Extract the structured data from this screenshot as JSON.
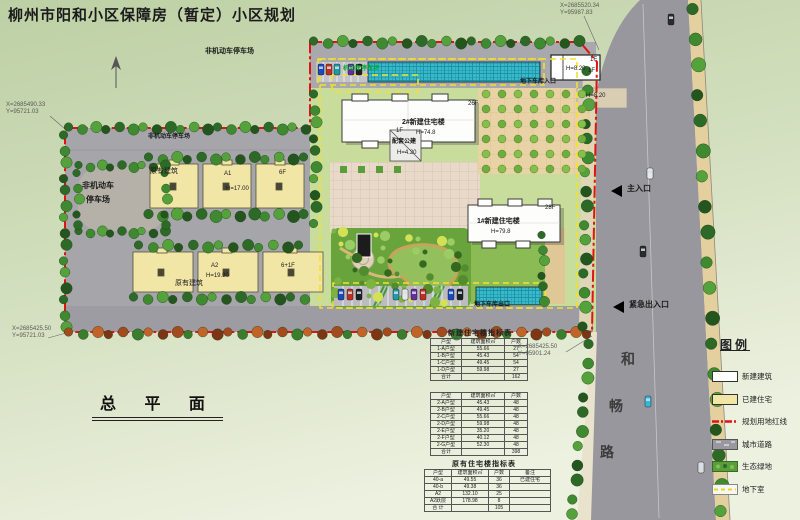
{
  "title": "柳州市阳和小区保障房（暂定）小区规划",
  "plan_name": "总 平 面",
  "coordinates": {
    "top_right": {
      "x": "X=2685520.34",
      "y": "Y=95987.83"
    },
    "mid_left": {
      "x": "X=2685490.33",
      "y": "Y=95721.03"
    },
    "bottom_left": {
      "x": "X=2685425.50",
      "y": "Y=95721.03"
    },
    "inner_right": {
      "x": "X=2685425.50",
      "y": "Y=95901.24"
    }
  },
  "labels": {
    "nonmotor_parking_top": "非机动车停车场",
    "motor_parking": "机动车停车场",
    "garage_entrance": "地下车库入口",
    "garage_exit": "地下车库出口",
    "nonmotor_parking_strip": "非机动车停车场",
    "nonmotor_lot_line1": "非机动车",
    "nonmotor_lot_line2": "停车场",
    "existing_building_1": "原有建筑",
    "existing_building_2": "原有建筑",
    "a1": "A1",
    "a1_height": "H=17.00",
    "a1_floors": "6F",
    "a2": "A2",
    "a2_height": "H=19.90",
    "a2_floors": "6+1F",
    "tower2_name": "2#新建住宅楼",
    "tower2_height": "H=74.8",
    "tower2_floors": "26F",
    "tower1_name": "1#新建住宅楼",
    "tower1_height": "H=79.8",
    "tower1_floors": "28F",
    "annex_floor": "1F",
    "annex_name": "配套公建",
    "annex_height": "H=4.20",
    "service_floor_a": "1F",
    "service_floor_b": "1F",
    "service_height_a": "H=8.20",
    "service_height_b": "H=8.20",
    "main_entrance": "主入口",
    "emergency_entrance": "紧急出入口"
  },
  "road": {
    "name_char_1": "和",
    "name_char_2": "畅",
    "name_char_3": "路"
  },
  "legend": {
    "title": "图例",
    "items": [
      {
        "label": "新建建筑"
      },
      {
        "label": "已建住宅"
      },
      {
        "label": "规划用地红线"
      },
      {
        "label": "城市道路"
      },
      {
        "label": "生态绿地"
      },
      {
        "label": "地下室"
      }
    ]
  },
  "tables": {
    "new_title": "新建住宅楼指标表",
    "existing_title": "原有住宅楼指标表",
    "table1": {
      "headers": [
        "户型",
        "建筑面积㎡",
        "户数"
      ],
      "rows": [
        [
          "1-A户型",
          "55.66",
          "27"
        ],
        [
          "1-B户型",
          "45.43",
          "54"
        ],
        [
          "1-C户型",
          "49.45",
          "54"
        ],
        [
          "1-D户型",
          "59.98",
          "27"
        ],
        [
          "合计",
          "",
          "162"
        ]
      ]
    },
    "table2": {
      "headers": [
        "户型",
        "建筑面积㎡",
        "户数"
      ],
      "rows": [
        [
          "2-A户型",
          "45.43",
          "48"
        ],
        [
          "2-B户型",
          "49.45",
          "48"
        ],
        [
          "2-C户型",
          "55.66",
          "48"
        ],
        [
          "2-D户型",
          "59.98",
          "48"
        ],
        [
          "2-E户型",
          "35.20",
          "48"
        ],
        [
          "2-F户型",
          "40.12",
          "48"
        ],
        [
          "2-G户型",
          "52.30",
          "48"
        ],
        [
          "合计",
          "",
          "398"
        ]
      ]
    },
    "table3": {
      "headers": [
        "户型",
        "建筑面积㎡",
        "户数",
        "备注"
      ],
      "rows": [
        [
          "40-a",
          "49.55",
          "36",
          "已建住宅"
        ],
        [
          "40-b",
          "49.38",
          "36",
          ""
        ],
        [
          "A2",
          "132.10",
          "25",
          ""
        ],
        [
          "A2跃层",
          "178.98",
          "8",
          ""
        ],
        [
          "合 计",
          "",
          "105",
          ""
        ]
      ]
    }
  },
  "colors": {
    "red_line": "#e31212",
    "basement_line": "#f2e12c",
    "existing_building": "#f1e6a6",
    "new_building": "#fdfdfb",
    "road": "#97979d",
    "sidewalk": "#e4d09e",
    "lawn": "#c8dc9c",
    "canopy": "#39b9c9"
  }
}
